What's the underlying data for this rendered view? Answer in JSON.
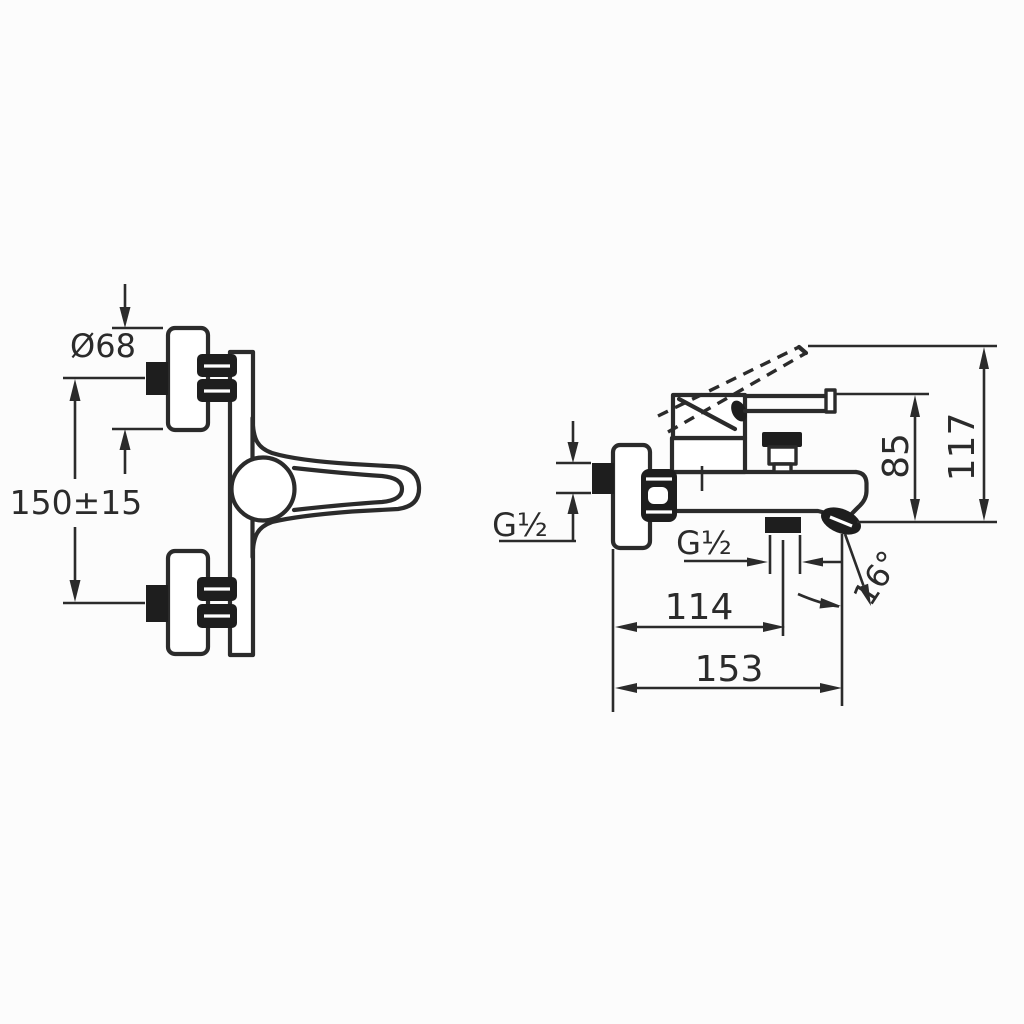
{
  "page": {
    "background": "#fcfcfc",
    "ink": "#2b2b2b"
  },
  "drawing": {
    "type": "technical-drawing",
    "subject": "wall-mounted single-lever bath/shower mixer, two orthographic views with dimensions",
    "front_view": {
      "labels": {
        "escutcheon_diameter": "Ø68",
        "connection_centers": "150±15"
      }
    },
    "side_view": {
      "labels": {
        "wall_connection_thread": "G½",
        "shower_outlet_thread": "G½",
        "spout_reach": "114",
        "overall_depth": "153",
        "handle_height": "85",
        "overall_height": "117",
        "spout_angle": "16°"
      }
    }
  }
}
